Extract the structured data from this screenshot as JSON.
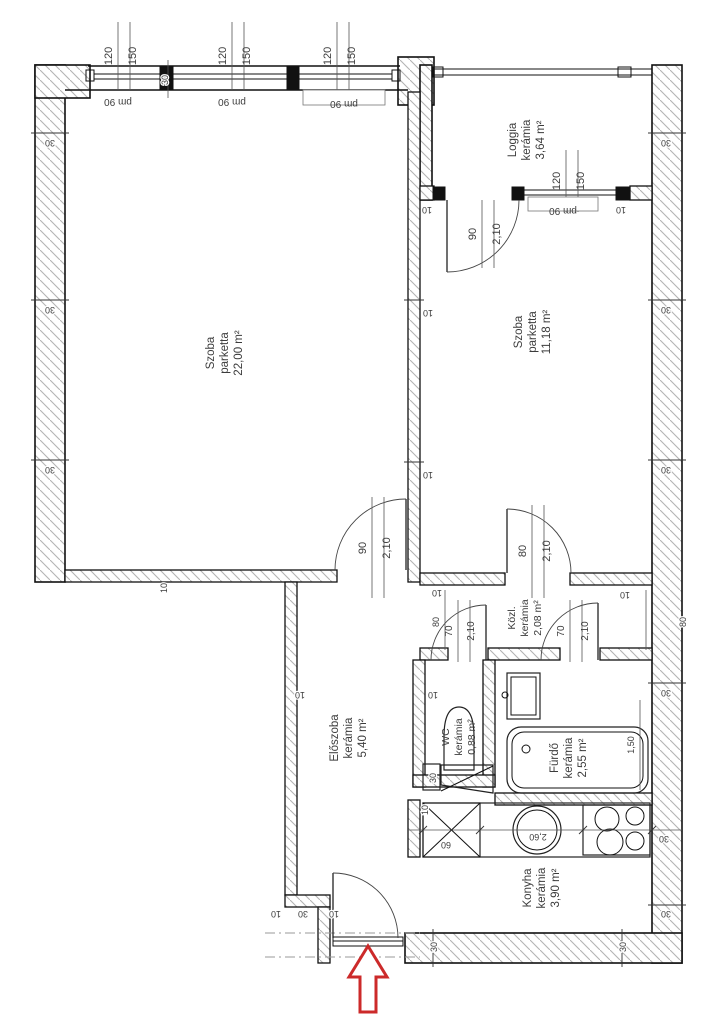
{
  "plan": {
    "rooms": [
      {
        "name": "Szoba",
        "material": "parketta",
        "area": "22,00 m²"
      },
      {
        "name": "Szoba",
        "material": "parketta",
        "area": "11,18 m²"
      },
      {
        "name": "Loggia",
        "material": "kerámia",
        "area": "3,64 m²"
      },
      {
        "name": "Közl.",
        "material": "kerámia",
        "area": "2,08 m²"
      },
      {
        "name": "Előszoba",
        "material": "kerámia",
        "area": "5,40 m²"
      },
      {
        "name": "WC",
        "material": "kerámia",
        "area": "0,88 m²"
      },
      {
        "name": "Fürdő",
        "material": "kerámia",
        "area": "2,55 m²"
      },
      {
        "name": "Konyha",
        "material": "kerámia",
        "area": "3,90 m²"
      }
    ],
    "openings": {
      "window_width": "120",
      "window_height": "150",
      "parapet_label": "pm 90",
      "door_width_90": "90",
      "door_width_80": "80",
      "door_width_70": "70",
      "door_height": "2,10"
    },
    "dimensions": {
      "wall_30": "30",
      "wall_10": "10",
      "dim_80": "80",
      "tub_length": "1,50",
      "counter_length": "2,60",
      "unit_width": "60"
    },
    "colors": {
      "line": "#1a1a1a",
      "hatch": "#b4b4b4",
      "text": "#3c3c3c",
      "entrance_arrow": "#cc2a2a"
    }
  }
}
